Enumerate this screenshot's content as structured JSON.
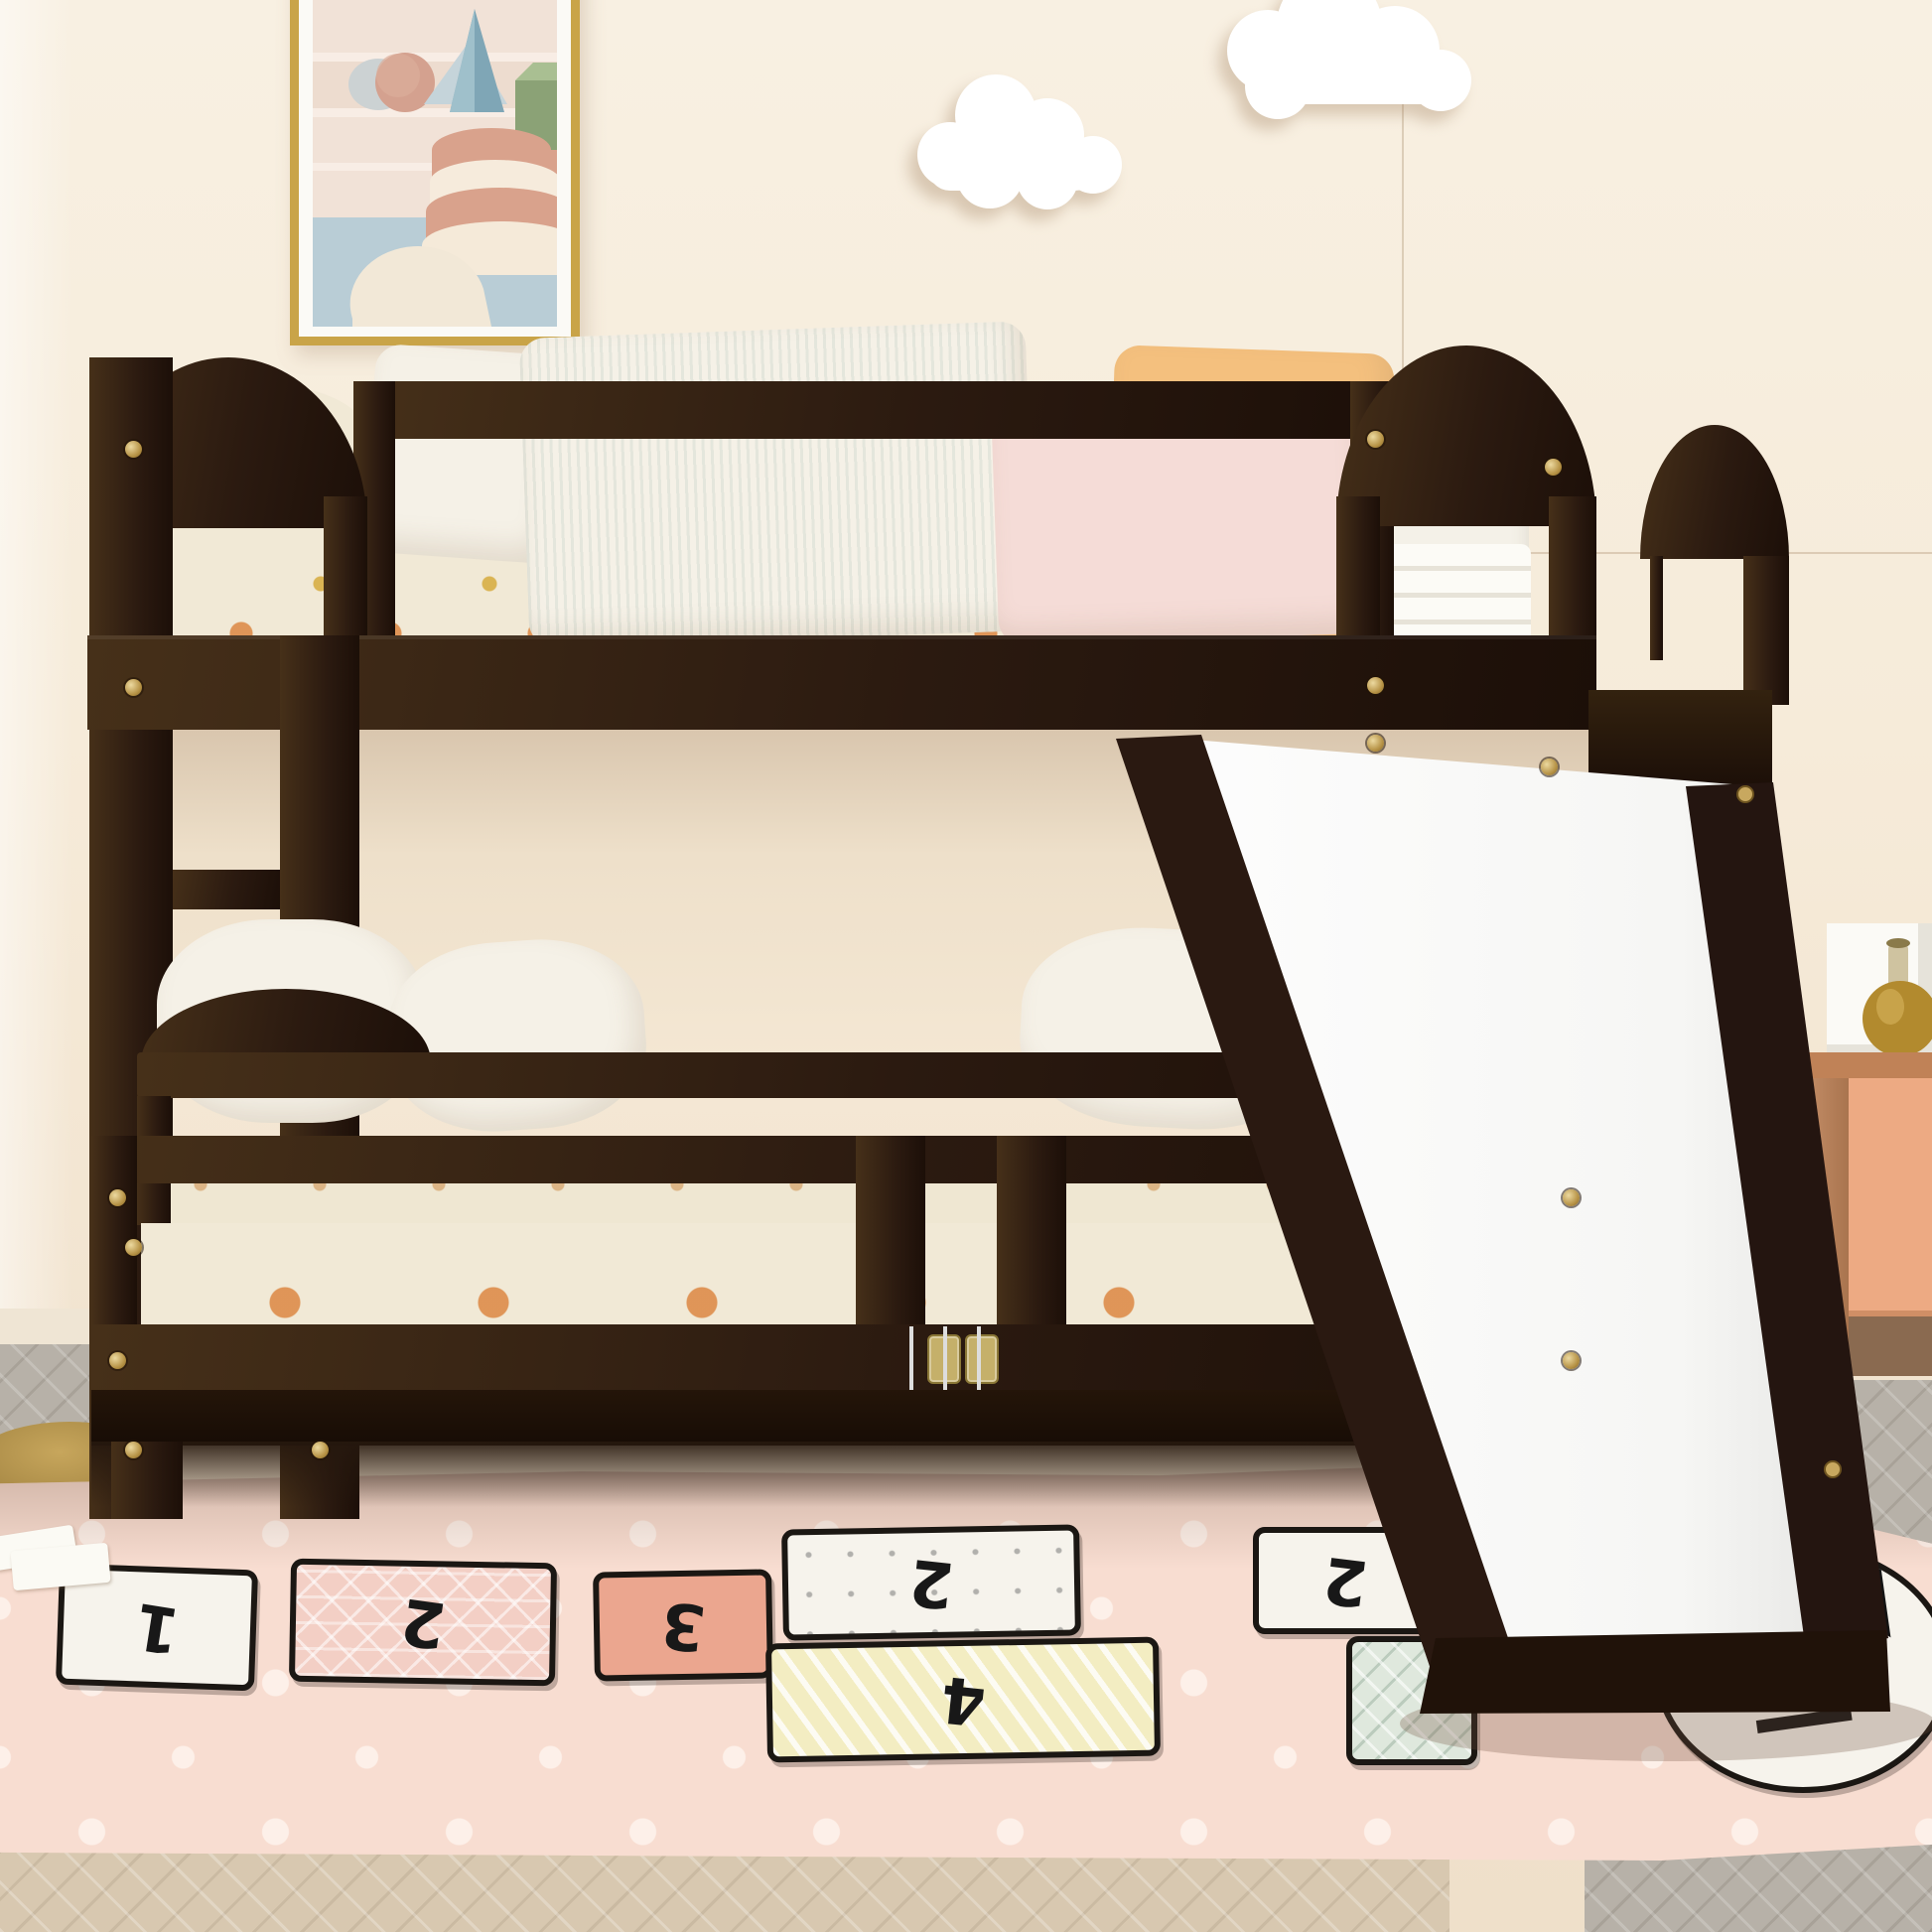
{
  "scene": {
    "setting": "kids bedroom, front product view",
    "subject": "espresso twin-over-twin low bunk bed with guardrails, left ladder, right convertible slide and two-door safety gate with brass hinges",
    "decor": [
      "framed pastel abstract art (gold frame)",
      "two white cloud wall decals",
      "pink polka-dot hopscotch play rug",
      "peach nightstand with white frame and amber bottle",
      "gold floor-lamp base disc"
    ]
  },
  "wall_art": {
    "frame_color": "gold",
    "shapes": [
      "pink sphere",
      "grey ellipse",
      "light blue triangle",
      "blue cone",
      "green cube",
      "layered pink-and-cream cake",
      "white half dome"
    ]
  },
  "rug": {
    "type": "hopscotch play mat",
    "orientation": "numbers appear upside-down to viewer",
    "patches": [
      {
        "label": "white square",
        "number": "1"
      },
      {
        "label": "pink triangle-grid square",
        "number": "2"
      },
      {
        "label": "salmon square",
        "number": "3"
      },
      {
        "label": "white dotted square",
        "number": "2"
      },
      {
        "label": "yellow striped square",
        "number": "4"
      },
      {
        "label": "white square right",
        "number": "2"
      },
      {
        "label": "green triangle square",
        "number": ""
      },
      {
        "label": "white circle with black glyphs",
        "number": ""
      }
    ]
  },
  "nightstand": {
    "items": [
      "white open frame",
      "amber glass bottle"
    ]
  },
  "structure": {
    "guardrail_slats": 10,
    "inner_rail_slats": 10,
    "gate_slats": 12,
    "left_spindles": 4,
    "right_spindles": 5,
    "back_spindles": 5,
    "ladder_rungs": [
      876,
      1168
    ],
    "screws": [
      [
        134,
        452
      ],
      [
        134,
        692
      ],
      [
        134,
        1256
      ],
      [
        134,
        1460
      ],
      [
        322,
        1460
      ],
      [
        1385,
        442
      ],
      [
        1385,
        690
      ],
      [
        1385,
        748
      ],
      [
        1564,
        470
      ],
      [
        1560,
        772
      ],
      [
        118,
        1206
      ],
      [
        118,
        1370
      ],
      [
        1582,
        1206
      ],
      [
        1582,
        1370
      ]
    ]
  },
  "colors": {
    "wall": "#f8f0e2",
    "wall_low": "#efe0ca",
    "wall_shadow": "#e2d1b9",
    "espresso": "#2b1a10",
    "espresso_hi": "#463019",
    "espresso_dark": "#1c0f08",
    "gold": "#c3a257",
    "mattress": "#f4f1e8",
    "knit": "#f1e9d6",
    "dot_orange": "#dd8c4a",
    "dot_yellow": "#d6aa3c",
    "pillow_white": "#f5f1e7",
    "pillow_pink": "#f5dcd7",
    "pillow_orange": "#f4c07e",
    "slide_white": "#fdfdfd",
    "slide_shade": "#e6e6e4",
    "rug": "#f8ddd1",
    "rug_dot": "#fdf0e9",
    "patch_white": "#f6f3ec",
    "patch_salmon": "#eba68f",
    "patch_pink": "#f3cfc5",
    "patch_yellow": "#f3edc2",
    "patch_green": "#dfe8dd",
    "outline": "#1b1713",
    "floor_grey": "#b7b1a8",
    "floor_tan": "#d8c8b0",
    "nw": "#bb8159",
    "np": "#edaa83",
    "frame_gold": "#c9a448",
    "art_sky": "#b9cdd6",
    "art_cream": "#f1e2d7",
    "art_pink": "#d9a28c",
    "art_green": "#8ba276",
    "art_blue": "#7fa6b6",
    "cloud": "#ffffff",
    "baseboard": "#efe5d4",
    "disc_gold": "#a98a46"
  }
}
